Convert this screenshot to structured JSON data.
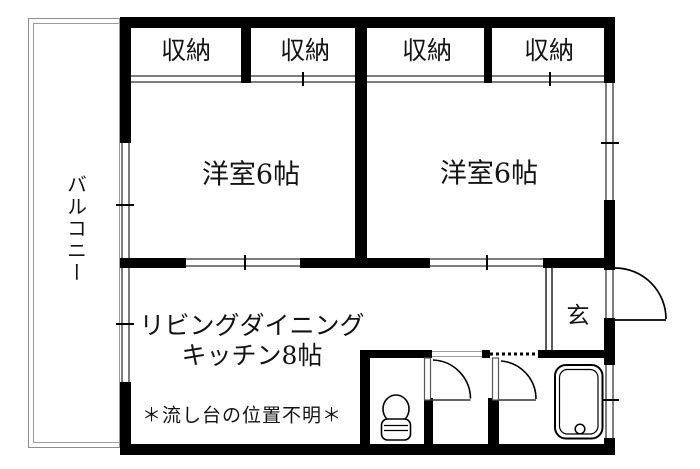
{
  "plan": {
    "title": "apartment-floor-plan",
    "balcony_label": "バルコニー",
    "closet_labels": [
      "収納",
      "収納",
      "収納",
      "収納"
    ],
    "bedroom1_label": "洋室6帖",
    "bedroom2_label": "洋室6帖",
    "ldk_label_line1": "リビングダイニング",
    "ldk_label_line2": "キッチン8帖",
    "sink_note": "＊流し台の位置不明＊",
    "entrance_label": "玄",
    "fixtures": [
      "entrance-swing-door",
      "interior-swing-door",
      "interior-swing-door",
      "toilet",
      "bathtub"
    ],
    "colors": {
      "wall": "#000000",
      "thin_line": "#7d7d7d",
      "balcony_line": "#8c8c8c",
      "text": "#141414",
      "background": "#ffffff"
    }
  }
}
